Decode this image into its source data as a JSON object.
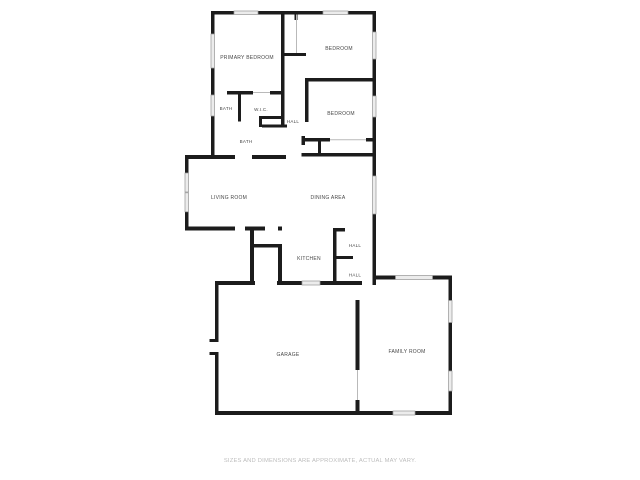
{
  "floor_plan": {
    "wall_color": "#1c1c1c",
    "window_color": "#ececec",
    "label_color": "#474747",
    "rooms": [
      {
        "id": "primary-bedroom",
        "label": "PRIMARY BEDROOM"
      },
      {
        "id": "bedroom-1",
        "label": "BEDROOM"
      },
      {
        "id": "bedroom-2",
        "label": "BEDROOM"
      },
      {
        "id": "bath-1",
        "label": "BATH"
      },
      {
        "id": "wic",
        "label": "W.I.C."
      },
      {
        "id": "hall-upper",
        "label": "HALL"
      },
      {
        "id": "bath-2",
        "label": "BATH"
      },
      {
        "id": "living-room",
        "label": "LIVING ROOM"
      },
      {
        "id": "dining-area",
        "label": "DINING AREA"
      },
      {
        "id": "kitchen",
        "label": "KITCHEN"
      },
      {
        "id": "hall-mid",
        "label": "HALL"
      },
      {
        "id": "hall-lower",
        "label": "HALL"
      },
      {
        "id": "garage",
        "label": "GARAGE"
      },
      {
        "id": "family-room",
        "label": "FAMILY ROOM"
      }
    ]
  },
  "disclaimer": {
    "text": "SIZES AND DIMENSIONS ARE APPROXIMATE, ACTUAL MAY VARY."
  }
}
